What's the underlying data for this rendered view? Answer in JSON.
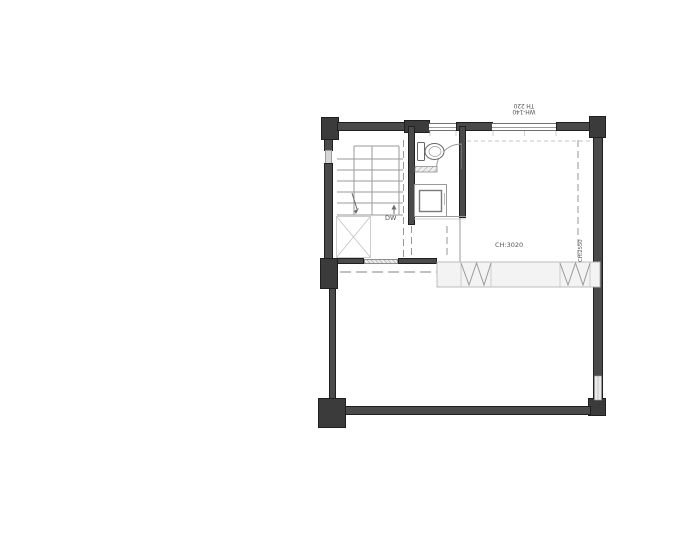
{
  "labels": {
    "window_tag": {
      "line1": "WH-140",
      "line2": "TH 220"
    },
    "right_wall_tag": "CH:2550",
    "appliance": "DW",
    "ceiling_height": "CH:3020"
  },
  "colors": {
    "wall": "#4a4a4a",
    "wall_dark": "#3b3b3b",
    "line": "#9a9a9a",
    "text": "#555555",
    "band_fill": "#f3f3f3",
    "background": "#ffffff"
  }
}
